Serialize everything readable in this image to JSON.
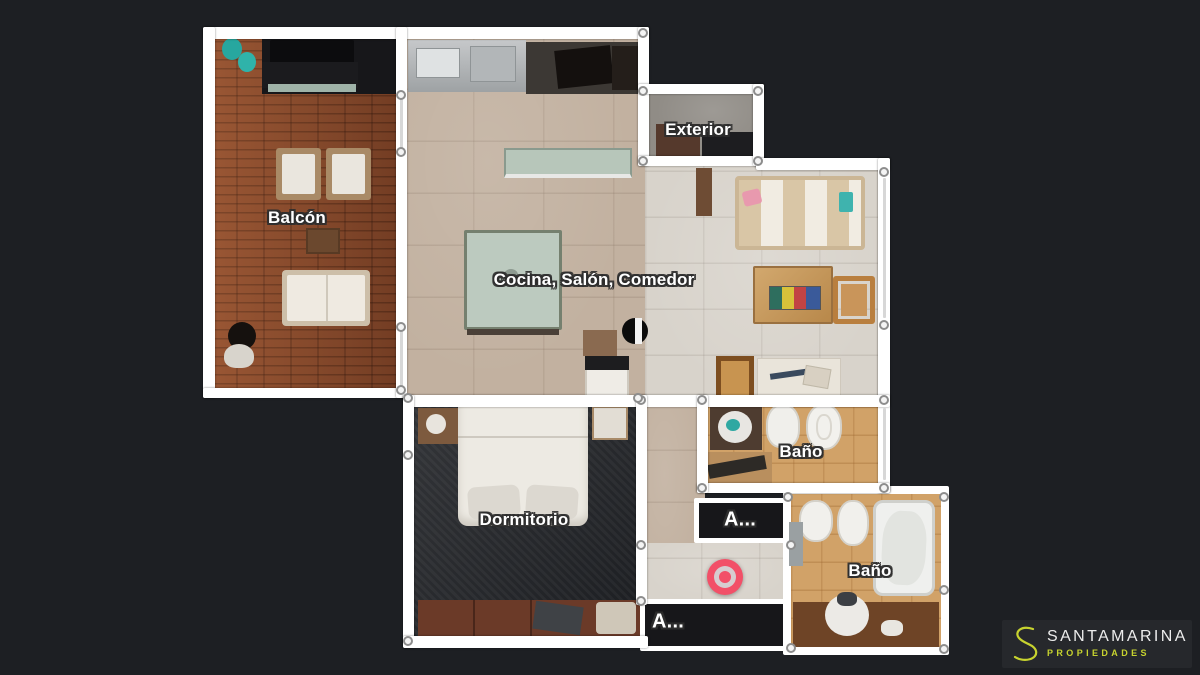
{
  "view": "floorplan-top-down",
  "rooms": {
    "balcon": "Balcón",
    "cocina_salon_comedor": "Cocina, Salón, Comedor",
    "exterior": "Exterior",
    "bano_1": "Baño",
    "bano_2": "Baño",
    "dormitorio": "Dormitorio",
    "armario_1": "A...",
    "armario_2": "A..."
  },
  "marker": {
    "type": "current-position",
    "color": "#f25068",
    "ring_color": "#d6cdd0"
  },
  "logo": {
    "initial": "S",
    "name": "SANTAMARINA",
    "tagline": "PROPIEDADES",
    "accent_color": "#c7d32f",
    "panel_color": "#26282c"
  },
  "colors": {
    "background": "#1d1f23",
    "walls": "#ffffff",
    "wood_deck": "#8c4a2b",
    "main_tile": "#c2b1a0",
    "bath_tile": "#d1a268",
    "dark_rooms": "#17171a"
  }
}
